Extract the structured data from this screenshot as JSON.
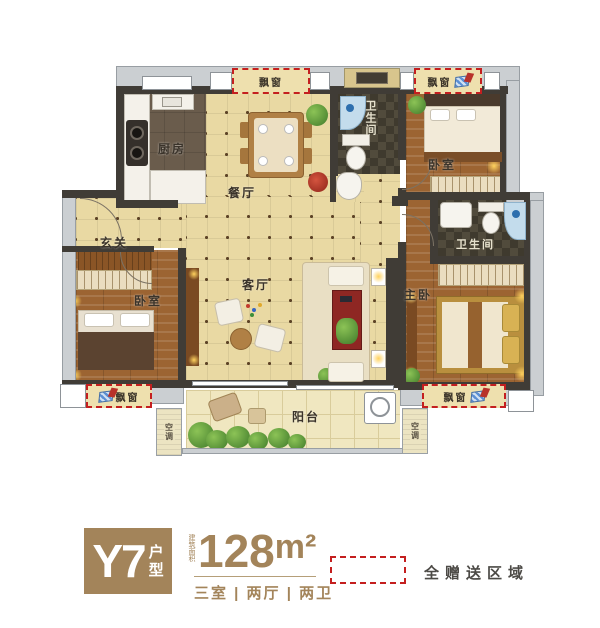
{
  "rooms": {
    "kitchen": "厨房",
    "dining": "餐厅",
    "bathroom": "卫生间",
    "bedroom": "卧室",
    "master_bedroom": "主卧",
    "entry": "玄关",
    "living": "客厅",
    "balcony": "阳台",
    "ac_unit": "空调",
    "bay_window": "飘窗"
  },
  "badge": {
    "model": "Y7",
    "type_char_top": "户",
    "type_char_bottom": "型"
  },
  "area": {
    "note": "建筑面积",
    "value": "128",
    "unit": "m²",
    "layout": "三室 | 两厅 | 两卫"
  },
  "legend": {
    "gift_area": "全赠送区域"
  },
  "colors": {
    "accent_red": "#c41f1f",
    "bronze": "#a3845a",
    "beige_floor": "#e9d9a3",
    "wood_floor": "#9c6432",
    "dark_tile": "#474234",
    "wall_gray": "#cbcfd2"
  }
}
